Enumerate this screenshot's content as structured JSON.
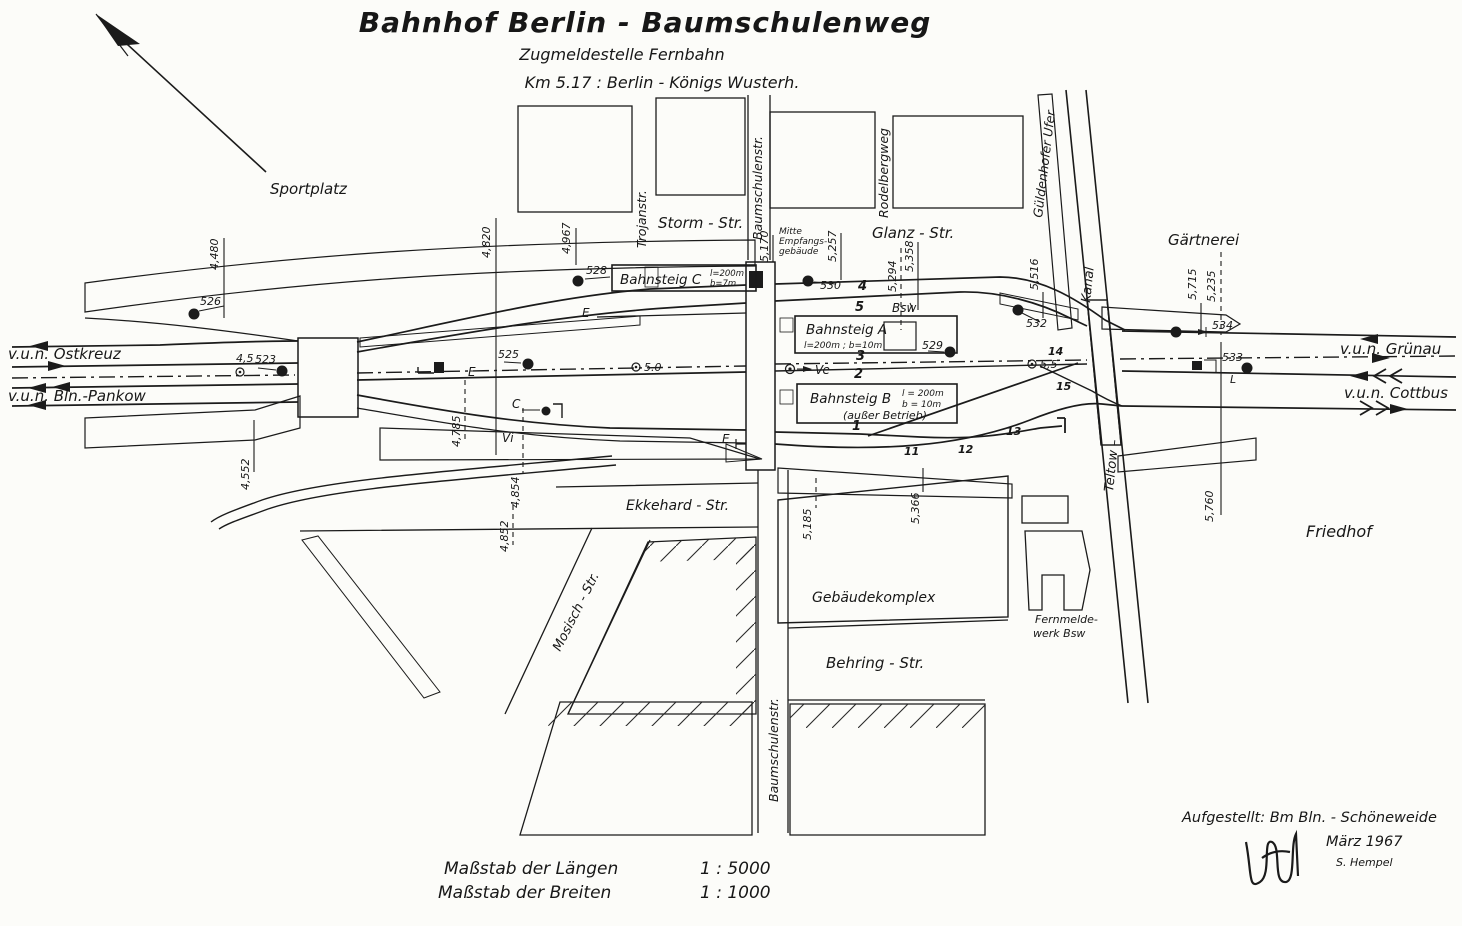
{
  "title": {
    "main": "Bahnhof  Berlin - Baumschulenweg",
    "sub1": "Zugmeldestelle    Fernbahn",
    "sub2": "Km 5.17  :    Berlin - Königs Wusterh."
  },
  "directions": {
    "ostkreuz": "v.u.n. Ostkreuz",
    "pankow": "v.u.n. Bln.-Pankow",
    "gruenau": "v.u.n. Grünau",
    "cottbus": "v.u.n. Cottbus"
  },
  "places": {
    "sportplatz": "Sportplatz",
    "gaertnerei": "Gärtnerei",
    "friedhof": "Friedhof",
    "gebaeude": "Gebäudekomplex",
    "fern1": "Fernmelde-",
    "fern2": "werk Bsw",
    "mitte1": "Mitte",
    "mitte2": "Empfangs-",
    "mitte3": "gebäude"
  },
  "streets": {
    "trojan": "Trojanstr.",
    "baum_top": "Baumschulenstr.",
    "rodelberg": "Rodelbergweg",
    "guelden": "Güldenhofer Ufer",
    "storm": "Storm - Str.",
    "glanz": "Glanz - Str.",
    "kanal": "Kanal",
    "teltow": "Teltow –",
    "ekkehard": "Ekkehard - Str.",
    "mosisch": "Mosisch - Str.",
    "behring": "Behring - Str.",
    "baum_bottom": "Baumschulenstr."
  },
  "platforms": {
    "c_name": "Bahnsteig C",
    "c_l": "l=200m",
    "c_b": "b=7m",
    "a_name": "Bahnsteig A",
    "a_dims": "l=200m ;   b=10m",
    "b_name": "Bahnsteig B",
    "b_l": "l = 200m",
    "b_b": "b = 10m",
    "b_note": "(außer Betrieb)"
  },
  "km": [
    "4,480",
    "4,820",
    "4,967",
    "5,170",
    "5,257",
    "5,294",
    "5,358",
    "5,516",
    "5,715",
    "5,235",
    "4,552",
    "4,785",
    "4,854",
    "4,852",
    "5,185",
    "5,366",
    "5,760"
  ],
  "axis": [
    "4,5",
    "5.0",
    "5,5"
  ],
  "signals": [
    "526",
    "523",
    "525",
    "528",
    "530",
    "529",
    "532",
    "534",
    "533"
  ],
  "tracks": [
    "4",
    "5",
    "3",
    "2",
    "1"
  ],
  "switches": [
    "11",
    "12",
    "13",
    "14",
    "15"
  ],
  "letters": {
    "e": "E",
    "c": "C",
    "vi": "Vi",
    "ve": "Ve",
    "l": "L",
    "bsw": "Bsw"
  },
  "scale": {
    "l1": "Maßstab der Längen",
    "v1": "1 :  5000",
    "l2": "Maßstab der Breiten",
    "v2": "1 :  1000"
  },
  "attribution": {
    "line1": "Aufgestellt:  Bm  Bln. - Schöneweide",
    "line2": "März 1967",
    "signer": "S. Hempel"
  }
}
